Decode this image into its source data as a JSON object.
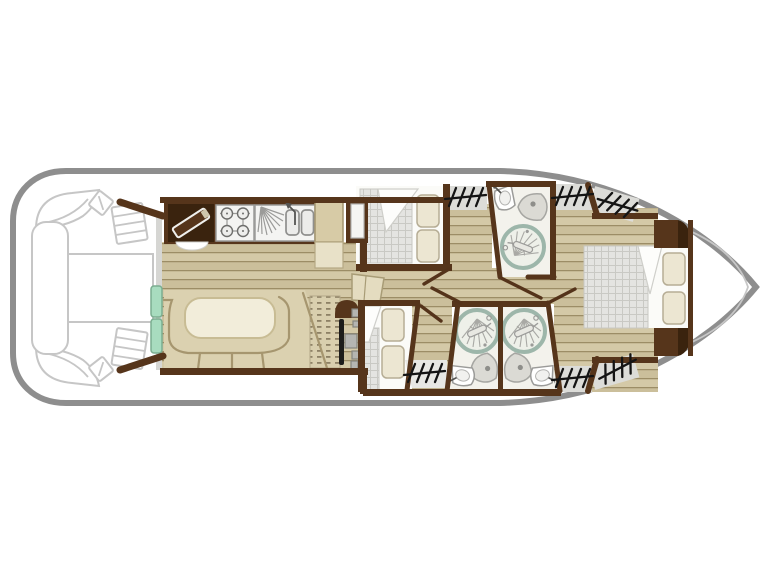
{
  "image": {
    "kind": "houseboat-deck-floor-plan",
    "width": 768,
    "height": 576,
    "orientation": "bow-right-stern-left"
  },
  "colors": {
    "hull": "#8e8e8e",
    "outline": "#c6c6c6",
    "wall": "#56351b",
    "wall_dark": "#3a230e",
    "wood_base": "#d3c8a6",
    "wood_alt": "#cbbf9b",
    "wood_line": "#9c8d66",
    "beige": "#dbd1b0",
    "beige_line": "#a6966f",
    "cream": "#f2edda",
    "cream_line": "#c8bc94",
    "pillow": "#ece6d2",
    "pillow_line": "#b6ad95",
    "check_base": "#e4e4e1",
    "check_line": "#c9c9c4",
    "teal": "#a8dcbf",
    "teal_line": "#7bad90",
    "shower_ring": "#9db6aa",
    "bath_floor": "#f3f2ec",
    "white_floor": "#fbfbf8",
    "gray_patch": "#dcdcd8",
    "hatch": "#141414",
    "fixture_fill": "#f4f4f2",
    "fixture_line": "#9b9b99",
    "steel": "#b5b5b1"
  },
  "areas": [
    "aft-deck",
    "galley",
    "saloon-dinette",
    "helm",
    "mid-cabin-top",
    "bathroom-top",
    "mid-cabin-bottom",
    "bathroom-bottom-left",
    "bathroom-bottom-right",
    "bow-cabin",
    "bow-deck"
  ],
  "fixtures": [
    "deck-corner-bench",
    "deck-side-bench",
    "deck-table",
    "deck-steps",
    "cutting-board",
    "gas-hob-4-burner",
    "double-sink-with-drainer",
    "fridge-cabinet",
    "dinette-u-sofa",
    "dinette-table",
    "sliding-door",
    "helm-wheel-console",
    "wardrobe",
    "double-bed",
    "pillows",
    "shower-cabin",
    "toilet",
    "washbasin",
    "companionway-steps-marks",
    "door-swing"
  ],
  "counts": {
    "cabins": 3,
    "bathrooms": 3,
    "showers": 3,
    "toilets": 3,
    "washbasins": 3,
    "beds": 3
  }
}
